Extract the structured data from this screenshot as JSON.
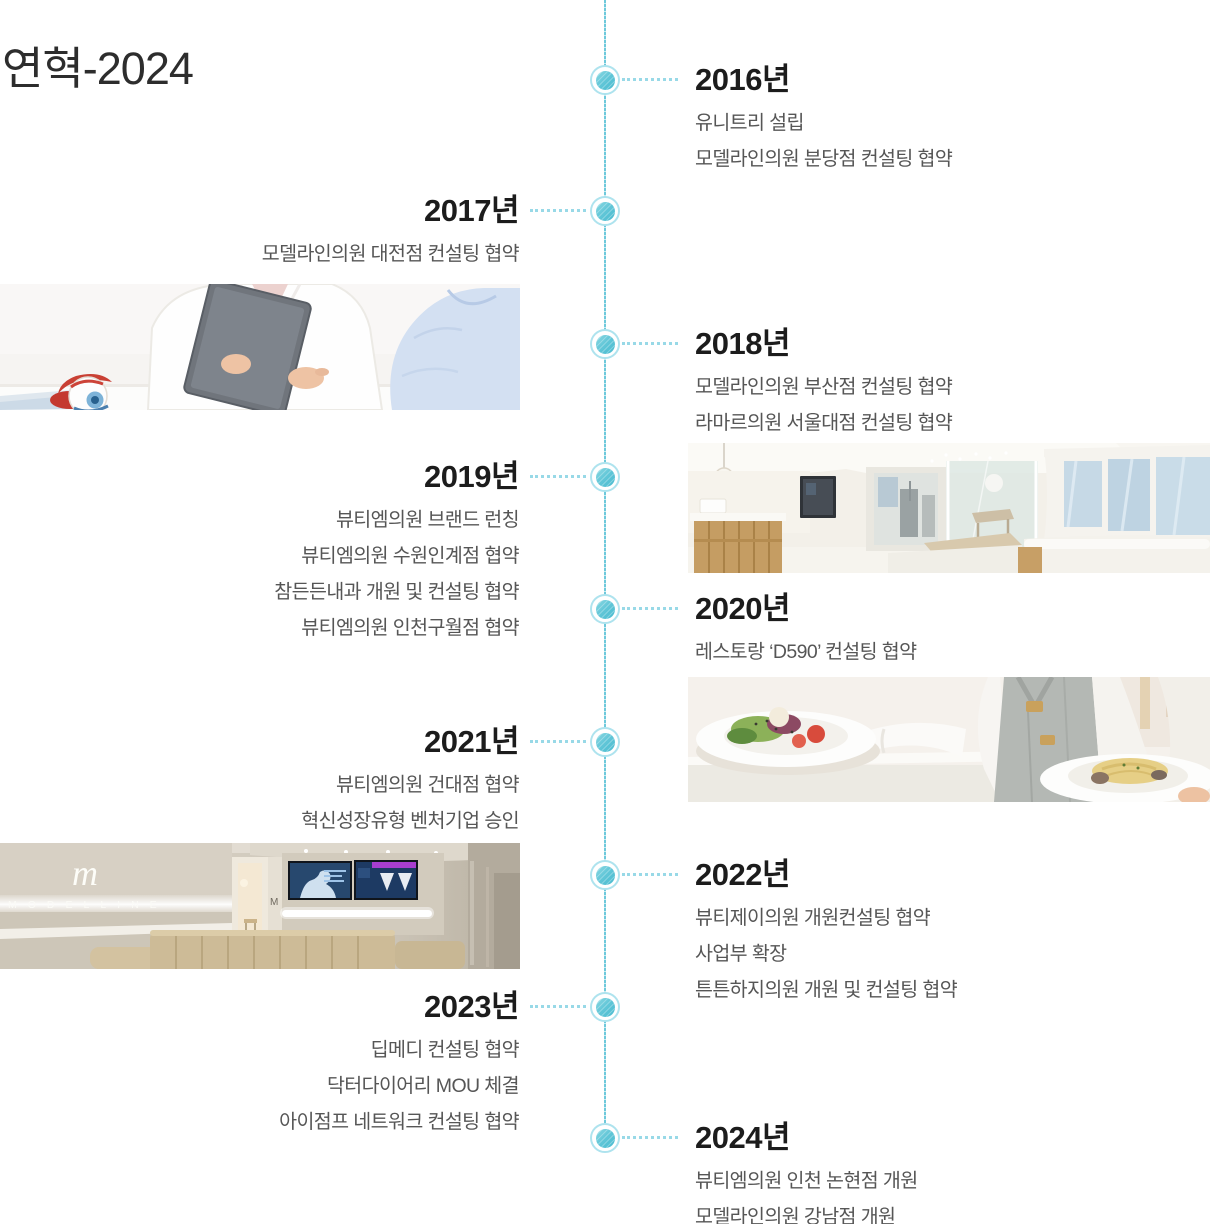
{
  "title": "연혁-2024",
  "timeline": [
    {
      "year": "2016년",
      "items": [
        "유니트리 설립",
        "모델라인의원 분당점 컨설팅 협약"
      ]
    },
    {
      "year": "2017년",
      "items": [
        "모델라인의원 대전점 컨설팅 협약"
      ]
    },
    {
      "year": "2018년",
      "items": [
        "모델라인의원 부산점 컨설팅 협약",
        "라마르의원 서울대점 컨설팅 협약"
      ]
    },
    {
      "year": "2019년",
      "items": [
        "뷰티엠의원 브랜드 런칭",
        "뷰티엠의원 수원인계점 협약",
        "참든든내과 개원 및 컨설팅 협약",
        "뷰티엠의원 인천구월점 협약"
      ]
    },
    {
      "year": "2020년",
      "items": [
        "레스토랑 ‘D590’ 컨설팅 협약"
      ]
    },
    {
      "year": "2021년",
      "items": [
        "뷰티엠의원 건대점 협약",
        "혁신성장유형 벤처기업 승인"
      ]
    },
    {
      "year": "2022년",
      "items": [
        "뷰티제이의원 개원컨설팅 협약",
        "사업부 확장",
        "튼튼하지의원 개원 및 컨설팅 협약"
      ]
    },
    {
      "year": "2023년",
      "items": [
        "딥메디 컨설팅 협약",
        "닥터다이어리 MOU 체결",
        "아이점프 네트워크 컨설팅 협약"
      ]
    },
    {
      "year": "2024년",
      "items": [
        "뷰티엠의원 인천 논현점 개원",
        "모델라인의원 강남점 개원"
      ]
    }
  ],
  "photos": {
    "consultation": "eye-clinic-consultation-photo",
    "clinic_interior": "clinic-interior-photo",
    "restaurant": "restaurant-serving-photo",
    "lobby": {
      "name": "modelline-lobby-photo",
      "neon_script": "m",
      "sign_text": "MODELLINE",
      "door_letter": "M"
    }
  },
  "theme": {
    "timeline_line": "#6ec9db",
    "node_fill": "#5fc5d6",
    "node_ring": "#aee3ee",
    "connector_dots": "#98d9e7",
    "year_text": "#1c1c1c",
    "item_text": "#565656",
    "background": "#ffffff"
  }
}
